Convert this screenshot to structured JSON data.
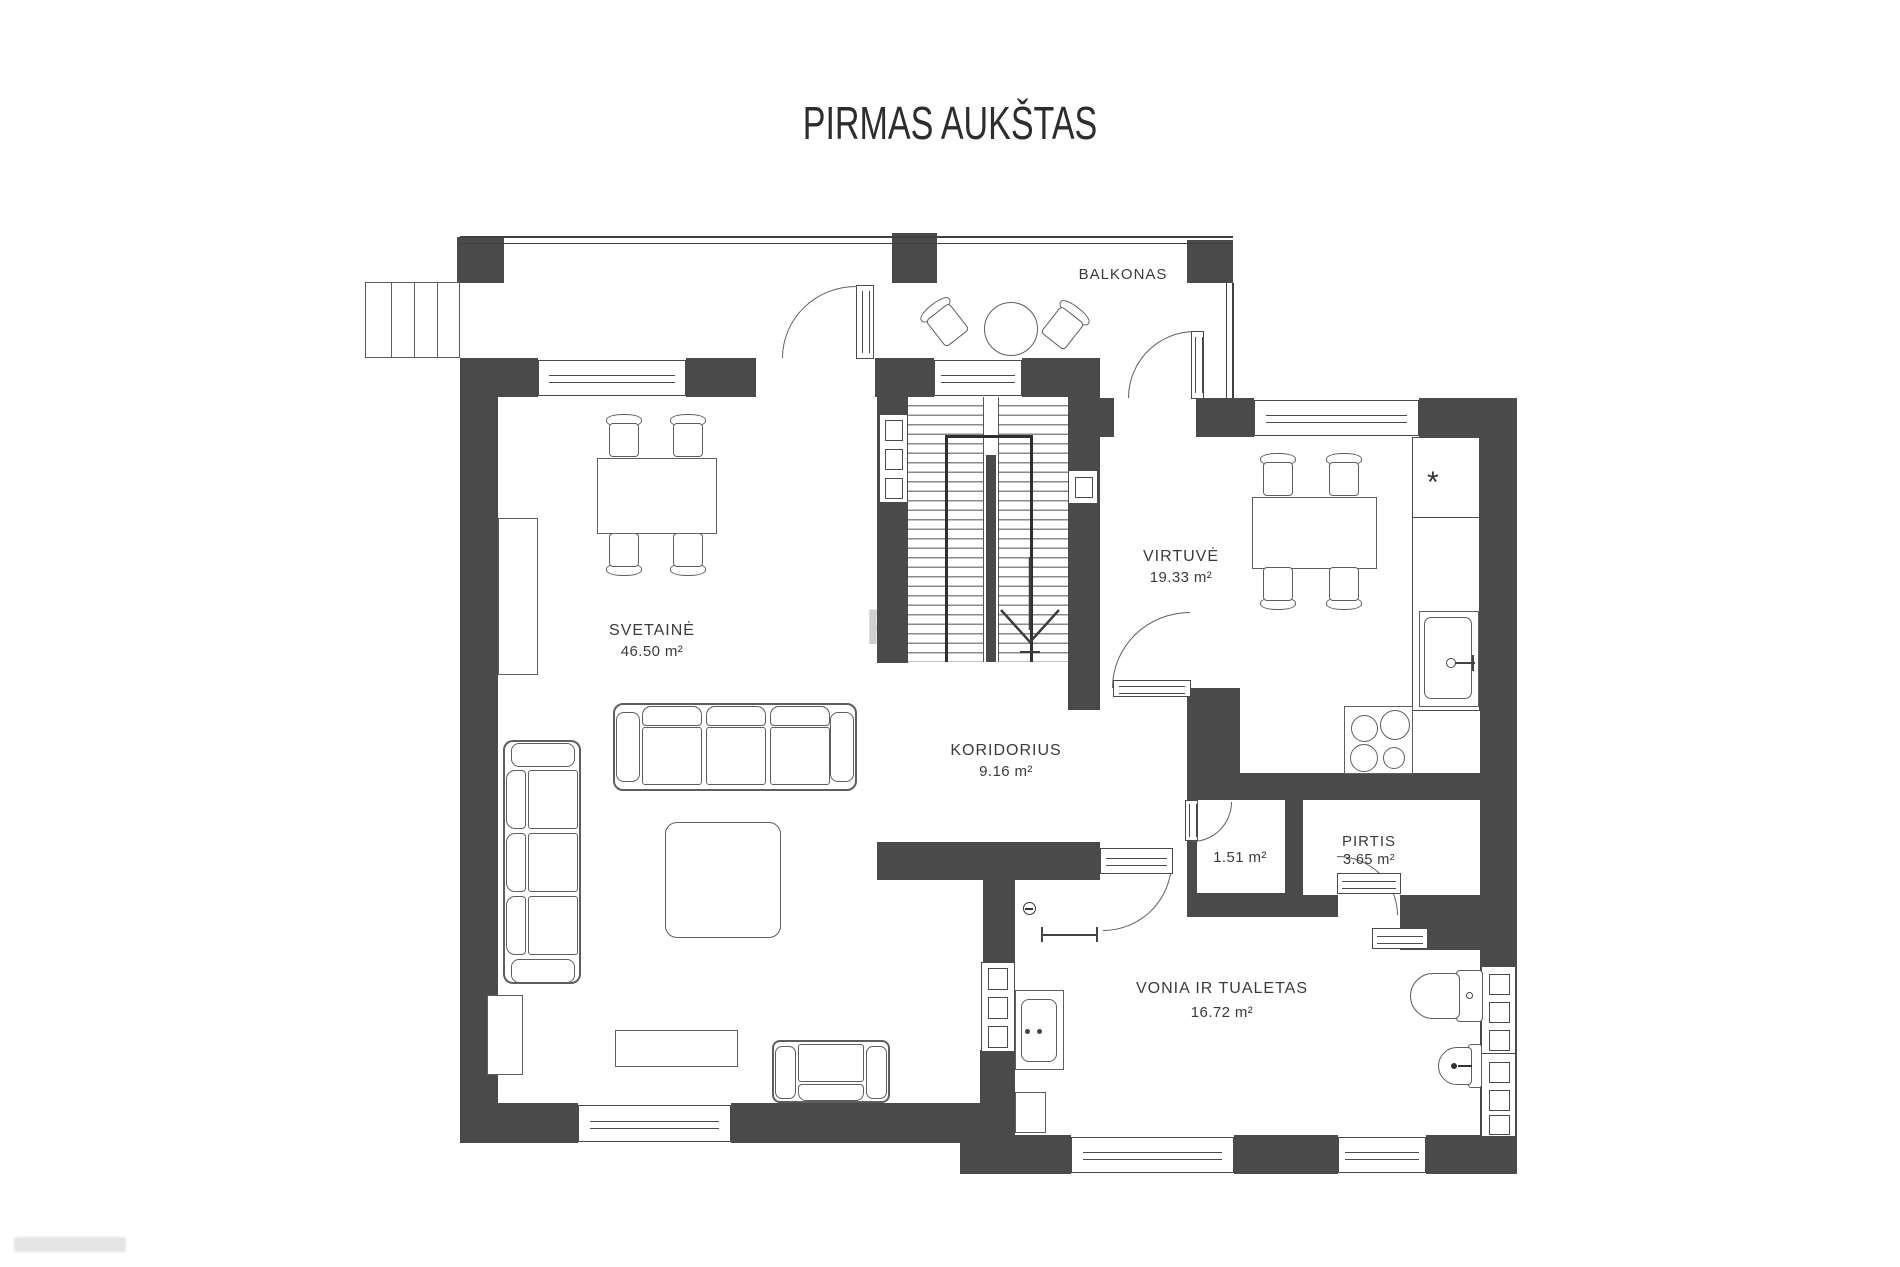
{
  "title": "PIRMAS AUKŠTAS",
  "labels": {
    "balkonas": "BALKONAS"
  },
  "rooms": {
    "svetaine": {
      "name": "SVETAINĖ",
      "area": "46.50 m²"
    },
    "virtuve": {
      "name": "VIRTUVĖ",
      "area": "19.33 m²"
    },
    "koridorius": {
      "name": "KORIDORIUS",
      "area": "9.16 m²"
    },
    "wc": {
      "area": "1.51 m²"
    },
    "pirtis": {
      "name": "PIRTIS",
      "area": "3.65 m²"
    },
    "vonia": {
      "name": "VONIA IR TUALETAS",
      "area": "16.72 m²"
    }
  },
  "kitchen": {
    "counter_symbol": "*"
  },
  "watermark": {
    "r": "R",
    "u": "U"
  }
}
